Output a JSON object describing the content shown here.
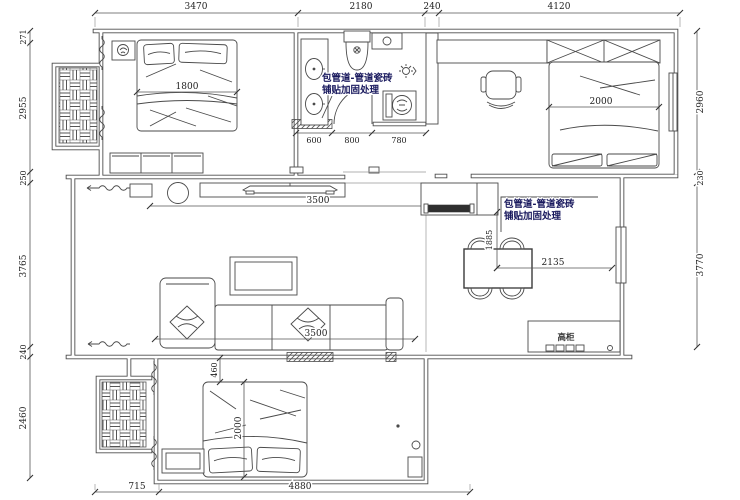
{
  "dimensions": {
    "top": [
      "3470",
      "2180",
      "240",
      "4120"
    ],
    "left": [
      "271",
      "2955",
      "250",
      "3765",
      "240",
      "2460"
    ],
    "right": [
      "2960",
      "230",
      "3770"
    ],
    "bottom": [
      "715",
      "4880"
    ]
  },
  "labels": {
    "master_bed_width": "1800",
    "bath_seg_1": "600",
    "bath_seg_2": "800",
    "bath_seg_3": "780",
    "study_bed_width": "2000",
    "tv_wall_width": "3500",
    "sofa_wall_width": "3500",
    "dining_depth": "1885",
    "dining_width": "2135",
    "bed2_gap": "460",
    "bed2_width": "2000"
  },
  "annotations": {
    "pipe_note_line1": "包管道-管道瓷砖",
    "pipe_note_line2": "铺贴加固处理",
    "tall_cabinet": "高柜"
  },
  "colors": {
    "background": "#ffffff",
    "wall_line": "#4d4d4d",
    "furniture_line": "#4a4a4a",
    "dim_line": "#555555",
    "dim_text": "#222222",
    "annotation_text": "#17175c",
    "appliance_fill": "#2f2f2f"
  }
}
